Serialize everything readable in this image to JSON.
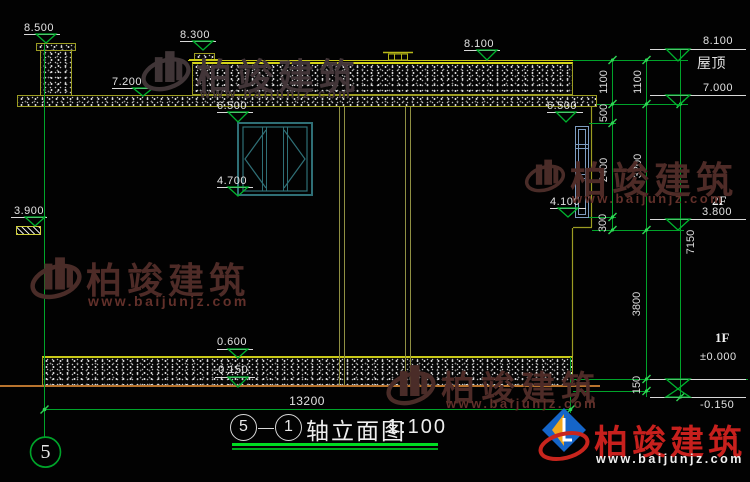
{
  "watermark": {
    "brand": "柏竣建筑",
    "url": "www.baijunjz.com"
  },
  "levels": {
    "chimney_top": "8.500",
    "parapet_left": "8.300",
    "roof_left": "7.200",
    "roof_center": "8.100",
    "window_center_top": "6.500",
    "window_center_bottom": "4.700",
    "canopy_left": "3.900",
    "window_right_top": "6.500",
    "window_right_bottom": "4.100",
    "plinth_top": "0.600",
    "ground_left": "-0.150"
  },
  "right_levels": {
    "parapet": "8.100",
    "roof_label": "屋顶",
    "roof": "7.000",
    "f2_label": "2F",
    "f2": "3.800",
    "f1_label": "1F",
    "f1": "±0.000",
    "ground": "-0.150"
  },
  "dims": {
    "overall_width": "13200",
    "overall_height": "7150",
    "a1": "1100",
    "a2": "500",
    "a3": "2400",
    "a4": "300",
    "b1": "1100",
    "b2": "3200",
    "b3": "3800",
    "b4": "150"
  },
  "title": {
    "axis_from": "5",
    "axis_to": "1",
    "name": "轴立面图",
    "scale": "1:100"
  },
  "axis": {
    "bubble": "5"
  }
}
